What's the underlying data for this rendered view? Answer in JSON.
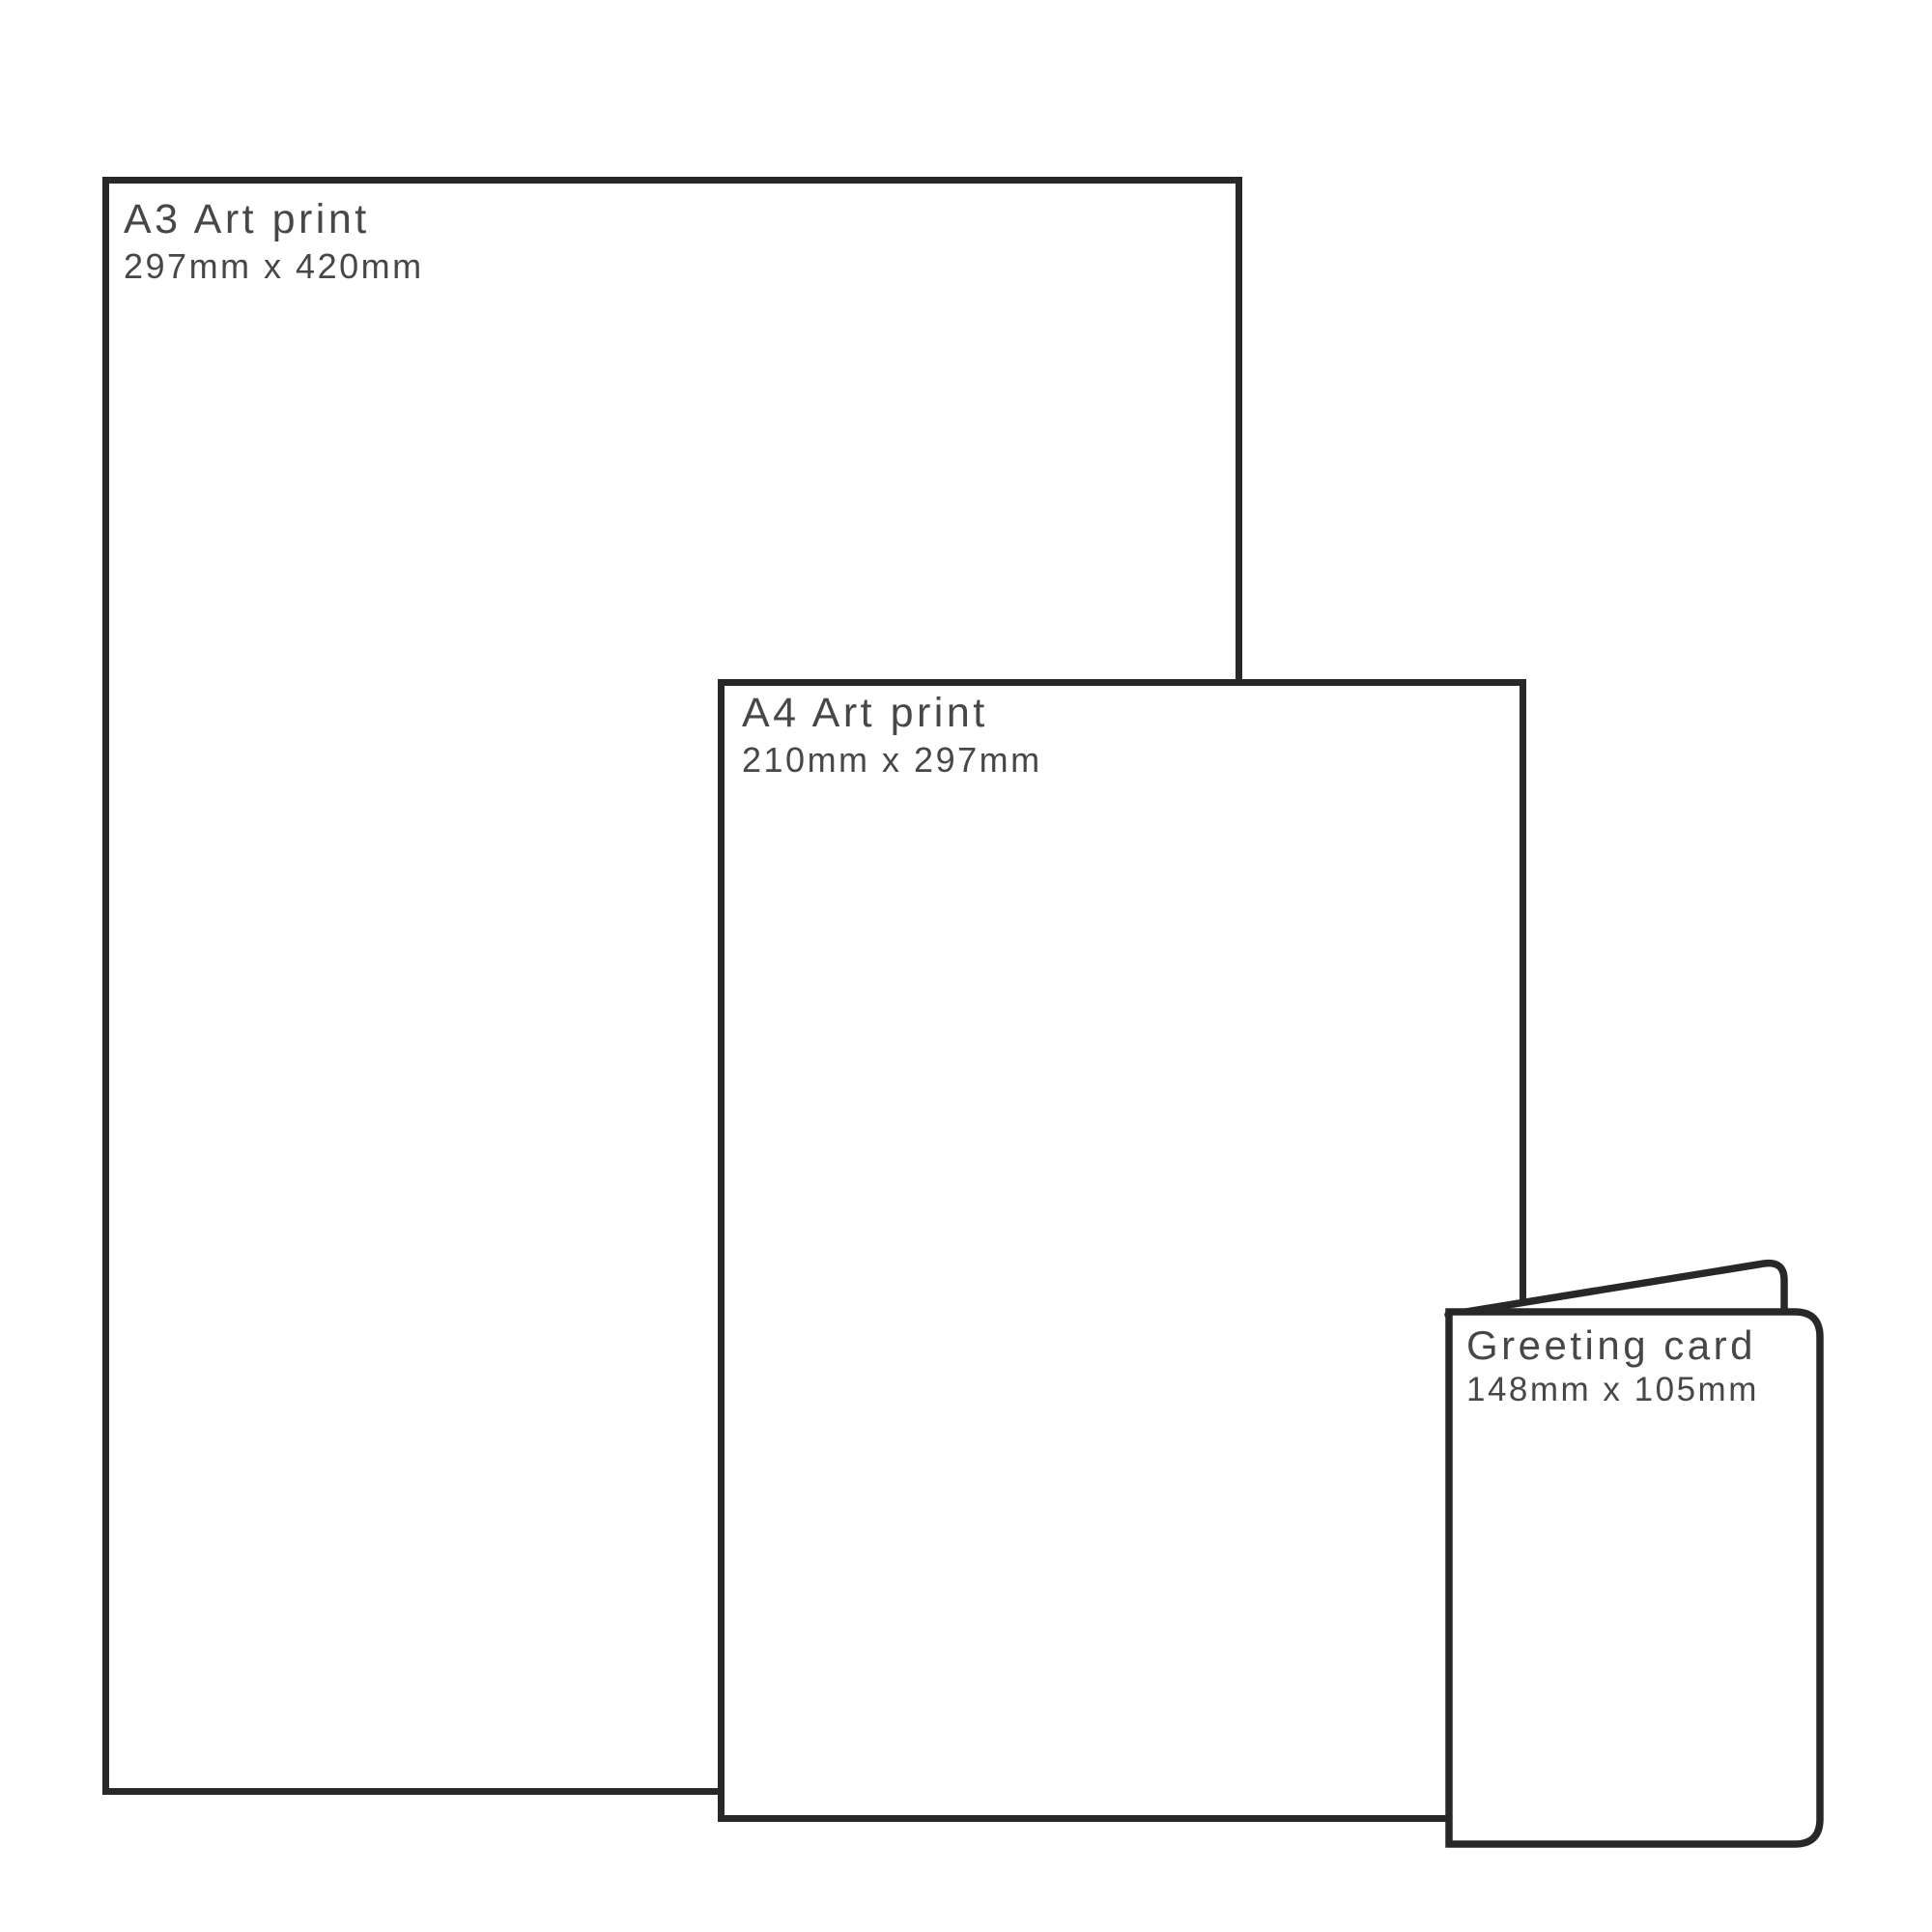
{
  "meta": {
    "description": "Print size comparison diagram",
    "background_color": "#ffffff",
    "outline_color": "#282828",
    "text_color": "#474747"
  },
  "items": [
    {
      "id": "a3-print",
      "title": "A3 Art print",
      "dimensions": "297mm x 420mm"
    },
    {
      "id": "a4-print",
      "title": "A4 Art print",
      "dimensions": "210mm x 297mm"
    },
    {
      "id": "greeting-card",
      "title": "Greeting card",
      "dimensions": "148mm x 105mm"
    }
  ]
}
